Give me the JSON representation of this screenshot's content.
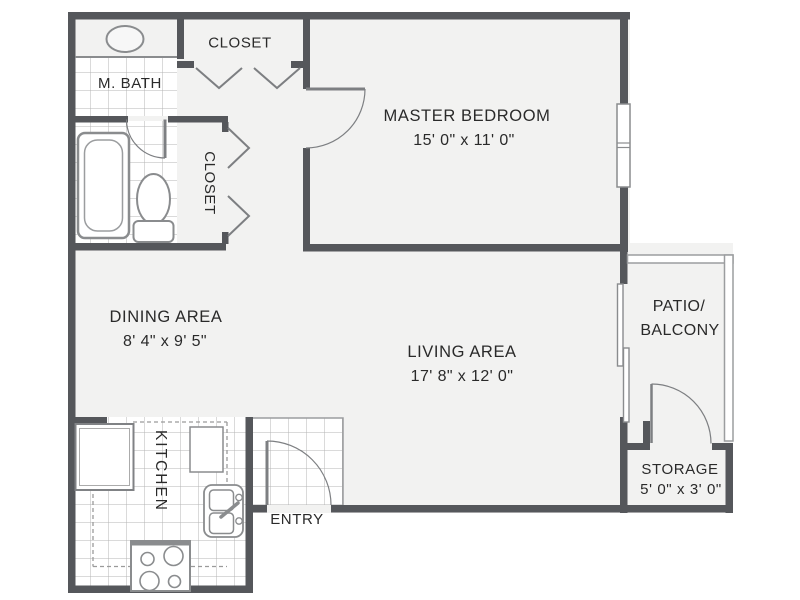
{
  "plan": {
    "title": "one-bedroom apartment floor plan",
    "rooms": {
      "master_bath": {
        "label": "M. BATH"
      },
      "closet_top": {
        "label": "CLOSET"
      },
      "closet_side": {
        "label": "CLOSET"
      },
      "master_bedroom": {
        "label": "MASTER BEDROOM",
        "dimensions": "15' 0\" x 11' 0\""
      },
      "dining": {
        "label": "DINING AREA",
        "dimensions": "8' 4\" x 9' 5\""
      },
      "living": {
        "label": "LIVING AREA",
        "dimensions": "17' 8\" x 12' 0\""
      },
      "patio": {
        "label_line1": "PATIO/",
        "label_line2": "BALCONY"
      },
      "storage": {
        "label": "STORAGE",
        "dimensions": "5' 0\" x 3' 0\""
      },
      "kitchen": {
        "label": "KITCHEN"
      },
      "entry": {
        "label": "ENTRY"
      }
    },
    "colors": {
      "wall": "#55575B",
      "floor": "#F2F2F1",
      "tile_line": "#B4B4B4",
      "fixture_line": "#8A8C8E",
      "door_line": "#7D7F82",
      "text": "#2A2A2A",
      "background": "#FFFFFF"
    }
  }
}
